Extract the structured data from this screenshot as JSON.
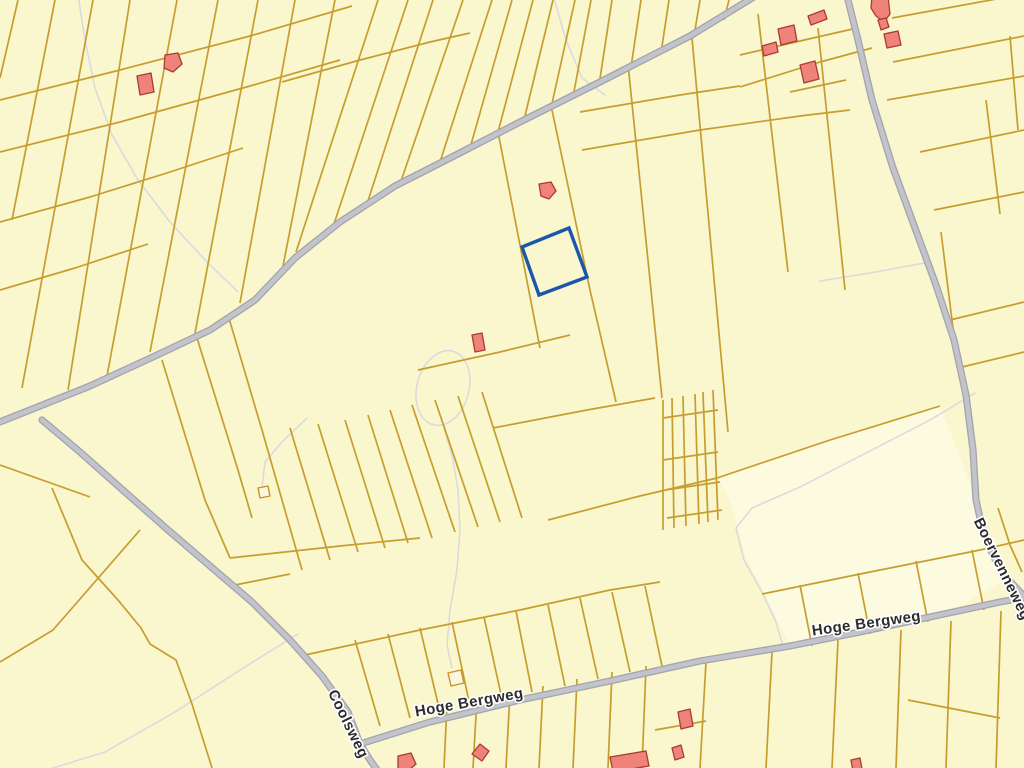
{
  "map": {
    "width": 1024,
    "height": 768,
    "colors": {
      "background": "#FAF6CD",
      "light_field": "#FCFADF",
      "parcel_line": "#C69E2F",
      "faint_path": "#D9D9DE",
      "road_fill": "#C3C3CB",
      "road_casing": "#A4A4AE",
      "building_fill": "#EF8379",
      "building_stroke": "#A93C31",
      "outlined_building_fill": "#FBF7DC",
      "outlined_building_stroke": "#CC8F2B",
      "highlight_stroke": "#1B57A9",
      "label_color": "#2d2d2d",
      "label_halo": "#ffffff"
    },
    "road_labels": [
      {
        "text": "Hoge Bergweg",
        "x": 470,
        "y": 707,
        "rot": -10
      },
      {
        "text": "Hoge Bergweg",
        "x": 867,
        "y": 628,
        "rot": -8
      },
      {
        "text": "Coolsweg",
        "x": 344,
        "y": 726,
        "rot": 64
      },
      {
        "text": "Boervenneweg",
        "x": 998,
        "y": 571,
        "rot": 64
      }
    ],
    "roads": [
      {
        "name": "main-diagonal-road",
        "pts": [
          762,
          -8,
          690,
          36,
          600,
          82,
          520,
          122,
          450,
          158,
          395,
          186,
          340,
          222,
          295,
          258,
          255,
          300,
          210,
          330,
          155,
          356,
          90,
          386,
          25,
          412,
          -8,
          425
        ]
      },
      {
        "name": "boervenneweg",
        "pts": [
          846,
          -8,
          858,
          40,
          872,
          100,
          893,
          168,
          915,
          228,
          936,
          285,
          954,
          340,
          966,
          395,
          973,
          450,
          976,
          500,
          982,
          527,
          993,
          556,
          1007,
          578,
          1022,
          594,
          1034,
          600
        ]
      },
      {
        "name": "hoge-bergweg",
        "pts": [
          360,
          744,
          430,
          722,
          520,
          700,
          610,
          681,
          700,
          661,
          790,
          646,
          860,
          632,
          930,
          617,
          1000,
          602,
          1034,
          596
        ]
      },
      {
        "name": "coolsweg",
        "pts": [
          42,
          420,
          80,
          452,
          125,
          492,
          168,
          530,
          210,
          566,
          252,
          602,
          290,
          640,
          322,
          676,
          348,
          712,
          360,
          744,
          370,
          760,
          380,
          774
        ]
      }
    ],
    "light_fields": [
      [
        717,
        478,
        940,
        406,
        975,
        495,
        1005,
        580,
        940,
        617,
        790,
        646,
        745,
        555,
        730,
        500
      ]
    ],
    "faint_paths": [
      [
        553,
        -5,
        566,
        40,
        582,
        78,
        605,
        95
      ],
      [
        78,
        -5,
        85,
        40,
        95,
        88,
        112,
        135,
        138,
        180,
        170,
        222,
        205,
        260,
        238,
        292
      ],
      [
        975,
        393,
        930,
        420,
        868,
        452,
        800,
        487,
        752,
        508,
        736,
        528,
        744,
        560,
        762,
        592,
        776,
        622,
        784,
        650
      ],
      [
        298,
        634,
        240,
        670,
        175,
        712,
        105,
        752,
        40,
        772
      ],
      [
        307,
        418,
        282,
        442,
        265,
        462,
        262,
        487
      ],
      [
        443,
        425,
        452,
        455,
        458,
        490,
        460,
        530,
        457,
        570,
        450,
        610,
        447,
        645,
        452,
        668
      ],
      [
        820,
        281,
        870,
        273,
        930,
        262
      ]
    ],
    "pond": {
      "cx": 443,
      "cy": 388,
      "rx": 26,
      "ry": 38,
      "rot": 15
    },
    "parcel_lines": [
      [
        18,
        0,
        0,
        78
      ],
      [
        55,
        0,
        12,
        220
      ],
      [
        93,
        0,
        22,
        388
      ],
      [
        130,
        0,
        68,
        390
      ],
      [
        177,
        0,
        107,
        376
      ],
      [
        218,
        0,
        150,
        352
      ],
      [
        258,
        0,
        195,
        333
      ],
      [
        295,
        0,
        240,
        303
      ],
      [
        335,
        0,
        283,
        266
      ],
      [
        378,
        0,
        296,
        252
      ],
      [
        408,
        0,
        332,
        230
      ],
      [
        433,
        0,
        366,
        207
      ],
      [
        463,
        0,
        400,
        184
      ],
      [
        492,
        0,
        440,
        162
      ],
      [
        512,
        0,
        470,
        148
      ],
      [
        533,
        0,
        498,
        132
      ],
      [
        553,
        0,
        524,
        120
      ],
      [
        575,
        0,
        551,
        108
      ],
      [
        591,
        0,
        573,
        97
      ],
      [
        612,
        0,
        599,
        85
      ],
      [
        641,
        0,
        631,
        67
      ],
      [
        669,
        0,
        661,
        53
      ],
      [
        700,
        0,
        694,
        36
      ],
      [
        729,
        0,
        724,
        20
      ],
      [
        0,
        100,
        120,
        70,
        250,
        36,
        352,
        6
      ],
      [
        0,
        152,
        120,
        122,
        250,
        86,
        340,
        60
      ],
      [
        0,
        222,
        90,
        197,
        170,
        172,
        243,
        148
      ],
      [
        0,
        290,
        75,
        268,
        148,
        244
      ],
      [
        282,
        82,
        360,
        60,
        430,
        42,
        470,
        33
      ],
      [
        892,
        18,
        1024,
        -6
      ],
      [
        893,
        62,
        1024,
        36
      ],
      [
        887,
        100,
        1024,
        76
      ],
      [
        920,
        152,
        1024,
        130
      ],
      [
        934,
        210,
        1024,
        192
      ],
      [
        986,
        100,
        1000,
        214
      ],
      [
        1010,
        36,
        1018,
        130
      ],
      [
        498,
        132,
        540,
        348
      ],
      [
        552,
        110,
        590,
        290,
        616,
        402
      ],
      [
        628,
        64,
        662,
        398
      ],
      [
        692,
        38,
        728,
        432
      ],
      [
        758,
        14,
        788,
        272
      ],
      [
        818,
        28,
        845,
        290
      ],
      [
        418,
        370,
        500,
        352,
        570,
        335
      ],
      [
        493,
        428,
        587,
        410,
        655,
        398
      ],
      [
        548,
        520,
        640,
        496,
        717,
        478,
        830,
        440,
        940,
        406
      ],
      [
        580,
        112,
        680,
        95,
        740,
        86
      ],
      [
        582,
        150,
        700,
        130,
        800,
        116,
        850,
        110
      ],
      [
        790,
        92,
        846,
        80
      ],
      [
        740,
        55,
        800,
        41,
        857,
        28
      ],
      [
        740,
        87,
        820,
        62,
        872,
        48
      ],
      [
        230,
        558,
        340,
        546,
        420,
        538
      ],
      [
        230,
        586,
        290,
        574
      ],
      [
        305,
        655,
        420,
        630,
        520,
        610,
        610,
        590,
        660,
        582
      ],
      [
        262,
        430,
        302,
        570
      ],
      [
        290,
        428,
        330,
        560
      ],
      [
        318,
        424,
        358,
        552
      ],
      [
        345,
        420,
        385,
        548
      ],
      [
        368,
        415,
        408,
        543
      ],
      [
        390,
        410,
        432,
        538
      ],
      [
        412,
        405,
        455,
        532
      ],
      [
        435,
        400,
        478,
        527
      ],
      [
        458,
        396,
        500,
        522
      ],
      [
        482,
        392,
        522,
        518
      ],
      [
        355,
        640,
        380,
        726
      ],
      [
        388,
        634,
        410,
        718
      ],
      [
        420,
        628,
        440,
        712
      ],
      [
        452,
        622,
        470,
        706
      ],
      [
        484,
        617,
        502,
        699
      ],
      [
        516,
        611,
        532,
        692
      ],
      [
        548,
        605,
        565,
        686
      ],
      [
        580,
        598,
        598,
        679
      ],
      [
        612,
        592,
        630,
        672
      ],
      [
        645,
        586,
        662,
        666
      ],
      [
        762,
        594,
        870,
        572,
        980,
        550,
        1024,
        540
      ],
      [
        800,
        585,
        812,
        646
      ],
      [
        858,
        573,
        870,
        634
      ],
      [
        916,
        561,
        928,
        622
      ],
      [
        972,
        550,
        984,
        610
      ],
      [
        706,
        662,
        700,
        768
      ],
      [
        772,
        652,
        766,
        768
      ],
      [
        838,
        640,
        832,
        768
      ],
      [
        901,
        630,
        896,
        768
      ],
      [
        951,
        621,
        946,
        768
      ],
      [
        1001,
        611,
        996,
        768
      ],
      [
        908,
        700,
        1000,
        718
      ],
      [
        655,
        730,
        706,
        721
      ],
      [
        447,
        704,
        444,
        768
      ],
      [
        477,
        698,
        473,
        768
      ],
      [
        510,
        692,
        506,
        768
      ],
      [
        543,
        686,
        539,
        768
      ],
      [
        577,
        679,
        573,
        768
      ],
      [
        612,
        672,
        608,
        768
      ],
      [
        646,
        666,
        642,
        768
      ],
      [
        52,
        488,
        82,
        560,
        118,
        600,
        141,
        628,
        150,
        644,
        176,
        660,
        192,
        704,
        212,
        768
      ],
      [
        0,
        465,
        90,
        497
      ],
      [
        140,
        530,
        53,
        630,
        0,
        662
      ],
      [
        162,
        360,
        205,
        500,
        230,
        558
      ],
      [
        197,
        338,
        238,
        470,
        252,
        518
      ],
      [
        228,
        315,
        262,
        430
      ],
      [
        663,
        400,
        663,
        530
      ],
      [
        672,
        398,
        674,
        528
      ],
      [
        683,
        396,
        686,
        526
      ],
      [
        695,
        394,
        699,
        524
      ],
      [
        703,
        392,
        708,
        522
      ],
      [
        713,
        390,
        718,
        520
      ],
      [
        663,
        418,
        718,
        410
      ],
      [
        663,
        460,
        718,
        452
      ],
      [
        665,
        490,
        720,
        482
      ],
      [
        667,
        518,
        722,
        510
      ],
      [
        941,
        232,
        952,
        320,
        958,
        368
      ],
      [
        950,
        320,
        1024,
        302
      ],
      [
        958,
        368,
        1024,
        352
      ],
      [
        998,
        508,
        1010,
        545,
        1022,
        572
      ]
    ],
    "outlined_buildings": [
      [
        448,
        673,
        461,
        670,
        464,
        683,
        451,
        686
      ],
      [
        258,
        488,
        268,
        486,
        270,
        496,
        260,
        498
      ]
    ],
    "buildings": [
      [
        165,
        55,
        178,
        53,
        182,
        64,
        173,
        72,
        164,
        68
      ],
      [
        137,
        76,
        151,
        73,
        154,
        92,
        140,
        95
      ],
      [
        808,
        16,
        824,
        10,
        827,
        19,
        811,
        25
      ],
      [
        778,
        29,
        794,
        25,
        797,
        41,
        781,
        45
      ],
      [
        762,
        46,
        776,
        42,
        778,
        52,
        764,
        56
      ],
      [
        872,
        -4,
        888,
        -4,
        890,
        14,
        884,
        22,
        876,
        16,
        871,
        8
      ],
      [
        878,
        20,
        886,
        18,
        889,
        27,
        881,
        30
      ],
      [
        884,
        34,
        898,
        31,
        901,
        45,
        887,
        48
      ],
      [
        800,
        65,
        815,
        61,
        819,
        79,
        804,
        83
      ],
      [
        539,
        184,
        551,
        182,
        556,
        191,
        549,
        199,
        541,
        196
      ],
      [
        472,
        335,
        482,
        333,
        485,
        350,
        475,
        352
      ],
      [
        398,
        756,
        411,
        753,
        416,
        764,
        408,
        771,
        398,
        768
      ],
      [
        480,
        744,
        489,
        751,
        482,
        761,
        472,
        754
      ],
      [
        610,
        757,
        646,
        751,
        649,
        766,
        613,
        772
      ],
      [
        678,
        712,
        690,
        709,
        693,
        726,
        681,
        729
      ],
      [
        672,
        748,
        681,
        745,
        684,
        757,
        675,
        760
      ],
      [
        851,
        760,
        860,
        758,
        862,
        769,
        853,
        771
      ]
    ],
    "highlight_parcel": [
      522,
      247,
      569,
      228,
      587,
      277,
      539,
      295
    ]
  }
}
